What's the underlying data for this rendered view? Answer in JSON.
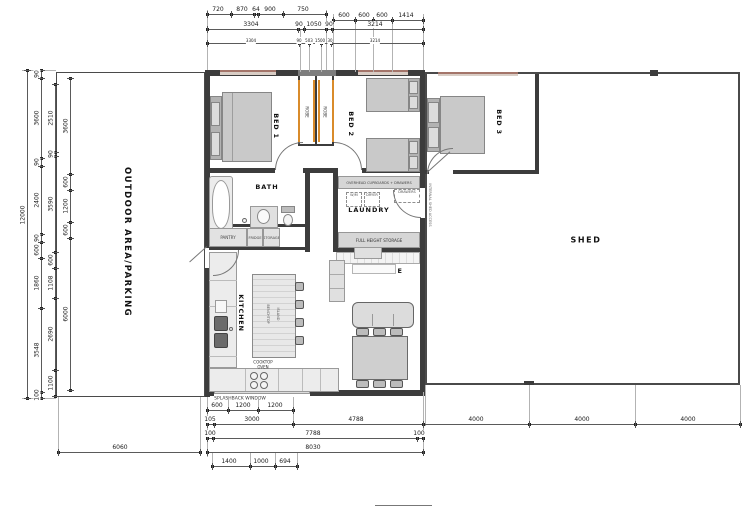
{
  "rooms": {
    "outdoor": "OUTDOOR AREA/PARKING",
    "bed1": "BED 1",
    "bed2": "BED 2",
    "bed3": "BED 3",
    "bath": "BATH",
    "laundry": "LAUNDRY",
    "lounge": "LOUNGE",
    "kitchen": "KITCHEN",
    "dining": "DINING",
    "shed": "SHED",
    "robe1": "ROBE",
    "robe2": "ROBE"
  },
  "kitchen_labels": {
    "cooktop": "COOKTOP",
    "oven": "OVEN",
    "splashback": "SPLASHBACK WINDOW",
    "island_a": "BENCHTOP",
    "island_b": "ISLAND",
    "pantry": "PANTRY",
    "fridge": "FRIDGE",
    "storage": "STORAGE"
  },
  "laundry_labels": {
    "overhead": "OVERHEAD CUPBOARDS + DRAWERS",
    "wm": "W/M",
    "dryer": "DRYER",
    "drawers": "DRAWERS",
    "full_height": "FULL HEIGHT STORAGE",
    "shed_access": "INTERNAL SHED ACCESS"
  },
  "colors": {
    "wall": "#3c3c3c",
    "robe_door_accent": "#d98b2b",
    "window_fill": "#d9cdc5",
    "window_edge": "#a4756a",
    "dim_line": "#5a5a5a"
  },
  "dims": {
    "h": [
      {
        "y": 14,
        "x1": 207,
        "x2": 326,
        "ticks": [
          207,
          231,
          254,
          258,
          283,
          326
        ],
        "labels": [
          [
            218,
            "720"
          ],
          [
            242,
            "870"
          ],
          [
            256,
            "64"
          ],
          [
            270,
            "900"
          ],
          [
            303,
            "750"
          ]
        ]
      },
      {
        "y": 20,
        "x1": 333,
        "x2": 423,
        "ticks": [
          333,
          355,
          373,
          392,
          423
        ],
        "labels": [
          [
            344,
            "600"
          ],
          [
            364,
            "600"
          ],
          [
            382,
            "600"
          ],
          [
            406,
            "1414"
          ]
        ]
      },
      {
        "y": 29,
        "x1": 207,
        "x2": 423,
        "ticks": [
          207,
          298,
          304,
          326,
          332,
          423
        ],
        "labels": [
          [
            251,
            "3304"
          ],
          [
            299,
            "90"
          ],
          [
            314,
            "1050"
          ],
          [
            329,
            "90"
          ],
          [
            375,
            "3214"
          ]
        ]
      },
      {
        "y": 43,
        "x1": 207,
        "x2": 423,
        "ticks": [
          207,
          299,
          309,
          321,
          331,
          423
        ],
        "small": true,
        "labels": [
          [
            251,
            "3304"
          ],
          [
            299,
            "90"
          ],
          [
            309,
            "503"
          ],
          [
            320,
            "1500"
          ],
          [
            330,
            "30"
          ],
          [
            375,
            "3214"
          ]
        ]
      },
      {
        "y": 410,
        "x1": 207,
        "x2": 293,
        "ticks": [
          207,
          228,
          258,
          293
        ],
        "labels": [
          [
            217,
            "600"
          ],
          [
            243,
            "1200"
          ],
          [
            275,
            "1200"
          ]
        ]
      },
      {
        "y": 424,
        "x1": 207,
        "x2": 423,
        "ticks": [
          207,
          214,
          293,
          423
        ],
        "labels": [
          [
            210,
            "105"
          ],
          [
            252,
            "3000"
          ],
          [
            356,
            "4788"
          ]
        ]
      },
      {
        "y": 424,
        "x1": 423,
        "x2": 740,
        "ticks": [
          423,
          529,
          635,
          740
        ],
        "labels": [
          [
            476,
            "4000"
          ],
          [
            582,
            "4000"
          ],
          [
            688,
            "4000"
          ]
        ]
      },
      {
        "y": 438,
        "x1": 207,
        "x2": 423,
        "ticks": [
          207,
          213,
          417,
          423
        ],
        "labels": [
          [
            210,
            "100"
          ],
          [
            313,
            "7788"
          ],
          [
            419,
            "100"
          ]
        ]
      },
      {
        "y": 452,
        "x1": 207,
        "x2": 423,
        "ticks": [
          207,
          423
        ],
        "labels": [
          [
            313,
            "8030"
          ]
        ]
      },
      {
        "y": 452,
        "x1": 58,
        "x2": 200,
        "ticks": [
          58,
          200
        ],
        "labels": [
          [
            120,
            "6060"
          ]
        ]
      },
      {
        "y": 466,
        "x1": 212,
        "x2": 297,
        "ticks": [
          212,
          250,
          275,
          297
        ],
        "labels": [
          [
            229,
            "1400"
          ],
          [
            261,
            "1000"
          ],
          [
            285,
            "694"
          ]
        ]
      }
    ],
    "v": [
      {
        "x": 27,
        "y1": 70,
        "y2": 398,
        "ticks": [
          70,
          398
        ],
        "labels": [
          [
            215,
            "12000"
          ]
        ]
      },
      {
        "x": 41,
        "y1": 70,
        "y2": 398,
        "ticks": [
          70,
          78,
          158,
          166,
          234,
          242,
          258,
          308,
          392,
          398
        ],
        "labels": [
          [
            74,
            "90"
          ],
          [
            118,
            "3600"
          ],
          [
            162,
            "90"
          ],
          [
            200,
            "2400"
          ],
          [
            238,
            "90"
          ],
          [
            250,
            "600"
          ],
          [
            283,
            "1860"
          ],
          [
            350,
            "3548"
          ],
          [
            395,
            "100"
          ]
        ]
      },
      {
        "x": 55,
        "y1": 84,
        "y2": 396,
        "ticks": [
          84,
          152,
          156,
          252,
          268,
          298,
          370,
          396
        ],
        "labels": [
          [
            118,
            "2510"
          ],
          [
            154,
            "90"
          ],
          [
            204,
            "3590"
          ],
          [
            260,
            "600"
          ],
          [
            283,
            "1108"
          ],
          [
            334,
            "2690"
          ],
          [
            383,
            "1100"
          ]
        ]
      },
      {
        "x": 70,
        "y1": 78,
        "y2": 390,
        "ticks": [
          78,
          174,
          190,
          222,
          238,
          390
        ],
        "labels": [
          [
            126,
            "3600"
          ],
          [
            182,
            "600"
          ],
          [
            206,
            "1200"
          ],
          [
            230,
            "600"
          ],
          [
            314,
            "6000"
          ]
        ]
      }
    ],
    "ext": [
      [
        207,
        10,
        1,
        60
      ],
      [
        326,
        10,
        1,
        60
      ],
      [
        423,
        14,
        1,
        56
      ],
      [
        333,
        14,
        1,
        56
      ],
      [
        300,
        29,
        1,
        43
      ],
      [
        355,
        20,
        1,
        52
      ],
      [
        373,
        20,
        1,
        52
      ],
      [
        392,
        20,
        1,
        52
      ],
      [
        309,
        43,
        1,
        29
      ],
      [
        321,
        43,
        1,
        29
      ],
      [
        207,
        397,
        1,
        60
      ],
      [
        423,
        392,
        1,
        64
      ],
      [
        228,
        397,
        1,
        15
      ],
      [
        258,
        397,
        1,
        15
      ],
      [
        293,
        397,
        1,
        29
      ],
      [
        212,
        452,
        1,
        16
      ],
      [
        250,
        452,
        1,
        16
      ],
      [
        275,
        452,
        1,
        16
      ],
      [
        297,
        452,
        1,
        16
      ],
      [
        58,
        397,
        1,
        57
      ],
      [
        200,
        397,
        1,
        57
      ],
      [
        529,
        385,
        1,
        41
      ],
      [
        635,
        385,
        1,
        41
      ],
      [
        740,
        385,
        1,
        41
      ],
      [
        425,
        385,
        1,
        41
      ],
      [
        417,
        430,
        1,
        10
      ],
      [
        22,
        70,
        34,
        1
      ],
      [
        22,
        398,
        34,
        1
      ]
    ],
    "misc_lines": [
      [
        375,
        505,
        57,
        1
      ]
    ]
  }
}
